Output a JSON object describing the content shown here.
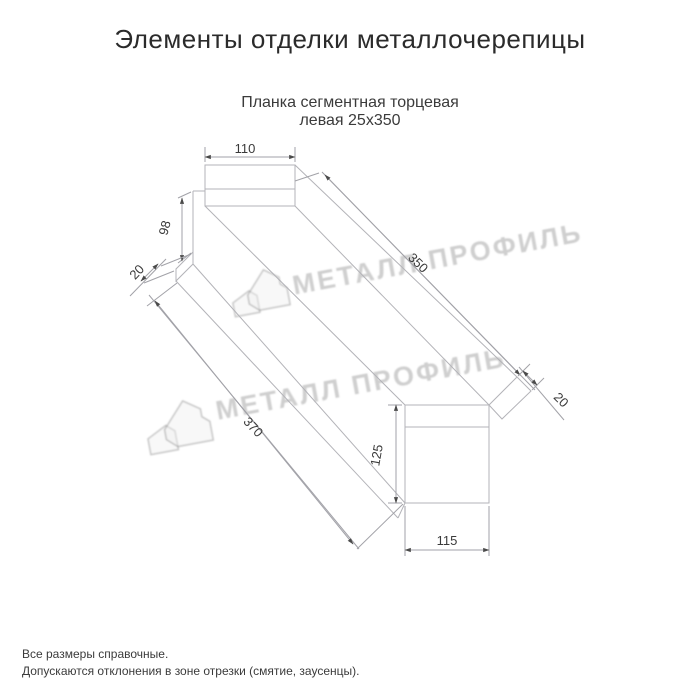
{
  "header": {
    "title": "Элементы отделки металлочерепицы"
  },
  "product": {
    "name_line1": "Планка сегментная торцевая",
    "name_line2": "левая 25x350"
  },
  "diagram": {
    "type": "technical-drawing",
    "dims": {
      "top_flange_width": "110",
      "left_face_height": "98",
      "left_hem": "20",
      "top_length": "350",
      "bottom_length": "370",
      "right_hem": "20",
      "right_face_height": "125",
      "bottom_flange_width": "115"
    },
    "watermark": {
      "text": "МЕТАЛЛ ПРОФИЛЬ",
      "logo": "metal-profil-house-logo"
    },
    "colors": {
      "part_line": "#b3b3b8",
      "dimension_line": "#a2a2a8",
      "label_text": "#3a3a3a",
      "watermark": "#808080"
    }
  },
  "footer": {
    "note1": "Все размеры справочные.",
    "note2": "Допускаются отклонения в зоне отрезки (смятие, заусенцы)."
  }
}
